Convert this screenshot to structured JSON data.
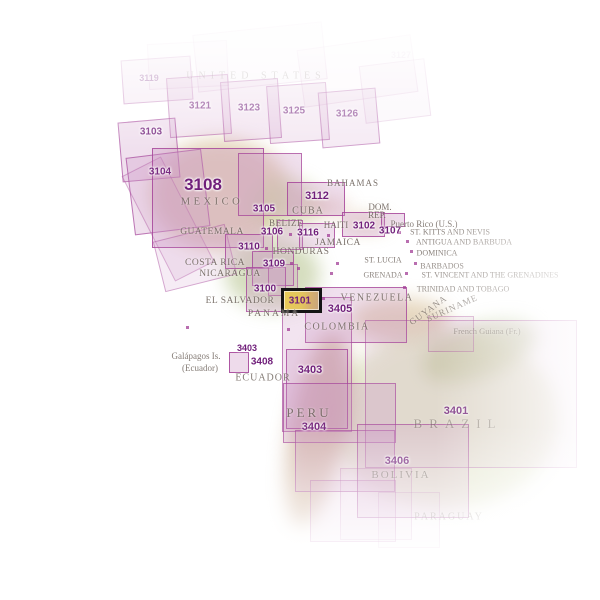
{
  "map": {
    "colors": {
      "region_fill_rgb": "206,152,198",
      "region_border_rgb": "162,62,150",
      "number_text": "#701f7a",
      "country_text": "#6f655e",
      "highlight_border": "#141414",
      "highlight_fill": "#e3c45e"
    },
    "highlight": {
      "label": "3101",
      "x": 281,
      "y": 288,
      "w": 41,
      "h": 25,
      "label_size": 10
    },
    "boxes": [
      {
        "name": "3119",
        "x": 122,
        "y": 58,
        "w": 70,
        "h": 44,
        "rot": -4,
        "fa": 0.18,
        "ba": 0.4
      },
      {
        "name": "3121",
        "x": 168,
        "y": 76,
        "w": 62,
        "h": 60,
        "rot": -4,
        "fa": 0.25,
        "ba": 0.5
      },
      {
        "name": "3123",
        "x": 222,
        "y": 80,
        "w": 58,
        "h": 60,
        "rot": -4,
        "fa": 0.25,
        "ba": 0.5
      },
      {
        "name": "3125",
        "x": 268,
        "y": 84,
        "w": 60,
        "h": 58,
        "rot": -4,
        "fa": 0.22,
        "ba": 0.45
      },
      {
        "name": "3126",
        "x": 320,
        "y": 90,
        "w": 58,
        "h": 56,
        "rot": -5,
        "fa": 0.2,
        "ba": 0.45
      },
      {
        "name": "us-faint-a",
        "x": 195,
        "y": 28,
        "w": 130,
        "h": 58,
        "rot": -6,
        "fa": 0.08,
        "ba": 0.15
      },
      {
        "name": "us-faint-b",
        "x": 300,
        "y": 42,
        "w": 115,
        "h": 58,
        "rot": -8,
        "fa": 0.07,
        "ba": 0.12
      },
      {
        "name": "us-faint-c",
        "x": 148,
        "y": 42,
        "w": 80,
        "h": 46,
        "rot": -3,
        "fa": 0.07,
        "ba": 0.12
      },
      {
        "name": "us-faint-d",
        "x": 362,
        "y": 62,
        "w": 66,
        "h": 58,
        "rot": -7,
        "fa": 0.08,
        "ba": 0.15
      },
      {
        "name": "3103",
        "x": 120,
        "y": 120,
        "w": 58,
        "h": 60,
        "rot": -5,
        "fa": 0.3,
        "ba": 0.65
      },
      {
        "name": "3104",
        "x": 130,
        "y": 153,
        "w": 76,
        "h": 78,
        "rot": -7,
        "fa": 0.3,
        "ba": 0.65
      },
      {
        "name": "baja-strip",
        "x": 146,
        "y": 160,
        "w": 44,
        "h": 118,
        "rot": -27,
        "fa": 0.18,
        "ba": 0.35
      },
      {
        "name": "3108",
        "x": 152,
        "y": 148,
        "w": 112,
        "h": 100,
        "rot": 0,
        "fa": 0.34,
        "ba": 0.8
      },
      {
        "name": "3108-coastal",
        "x": 158,
        "y": 232,
        "w": 74,
        "h": 52,
        "rot": -14,
        "fa": 0.18,
        "ba": 0.4
      },
      {
        "name": "3105",
        "x": 238,
        "y": 153,
        "w": 64,
        "h": 63,
        "rot": 0,
        "fa": 0.3,
        "ba": 0.7
      },
      {
        "name": "3112",
        "x": 287,
        "y": 182,
        "w": 58,
        "h": 34,
        "rot": 0,
        "fa": 0.32,
        "ba": 0.8
      },
      {
        "name": "3102",
        "x": 342,
        "y": 212,
        "w": 43,
        "h": 25,
        "rot": 0,
        "fa": 0.32,
        "ba": 0.8
      },
      {
        "name": "3107",
        "x": 381,
        "y": 213,
        "w": 24,
        "h": 14,
        "rot": 0,
        "fa": 0.32,
        "ba": 0.8
      },
      {
        "name": "3106",
        "x": 277,
        "y": 220,
        "w": 26,
        "h": 30,
        "rot": 0,
        "fa": 0.3,
        "ba": 0.75
      },
      {
        "name": "3116",
        "x": 299,
        "y": 223,
        "w": 36,
        "h": 25,
        "rot": 0,
        "fa": 0.3,
        "ba": 0.75
      },
      {
        "name": "3110",
        "x": 225,
        "y": 234,
        "w": 48,
        "h": 35,
        "rot": 0,
        "fa": 0.3,
        "ba": 0.75
      },
      {
        "name": "3109",
        "x": 252,
        "y": 251,
        "w": 42,
        "h": 35,
        "rot": 0,
        "fa": 0.3,
        "ba": 0.75
      },
      {
        "name": "3100",
        "x": 246,
        "y": 267,
        "w": 40,
        "h": 45,
        "rot": 0,
        "fa": 0.3,
        "ba": 0.75
      },
      {
        "name": "central-small",
        "x": 268,
        "y": 264,
        "w": 30,
        "h": 32,
        "rot": 0,
        "fa": 0.22,
        "ba": 0.5
      },
      {
        "name": "3405",
        "x": 305,
        "y": 287,
        "w": 102,
        "h": 56,
        "rot": 0,
        "fa": 0.3,
        "ba": 0.75
      },
      {
        "name": "colombia-tall",
        "x": 282,
        "y": 297,
        "w": 70,
        "h": 135,
        "rot": 0,
        "fa": 0.26,
        "ba": 0.6
      },
      {
        "name": "3403",
        "x": 286,
        "y": 349,
        "w": 62,
        "h": 80,
        "rot": 0,
        "fa": 0.3,
        "ba": 0.75
      },
      {
        "name": "3408-galapagos",
        "x": 229,
        "y": 352,
        "w": 20,
        "h": 21,
        "rot": 0,
        "fa": 0.35,
        "ba": 0.85
      },
      {
        "name": "3404-upper",
        "x": 283,
        "y": 383,
        "w": 113,
        "h": 60,
        "rot": 0,
        "fa": 0.28,
        "ba": 0.65
      },
      {
        "name": "3404-lower",
        "x": 295,
        "y": 430,
        "w": 100,
        "h": 62,
        "rot": 0,
        "fa": 0.26,
        "ba": 0.6
      },
      {
        "name": "3404-tail",
        "x": 310,
        "y": 480,
        "w": 86,
        "h": 62,
        "rot": 0,
        "fa": 0.18,
        "ba": 0.4
      },
      {
        "name": "3401",
        "x": 365,
        "y": 320,
        "w": 212,
        "h": 148,
        "rot": 0,
        "fa": 0.16,
        "ba": 0.45
      },
      {
        "name": "3401-step",
        "x": 428,
        "y": 316,
        "w": 46,
        "h": 36,
        "rot": 0,
        "fa": 0.12,
        "ba": 0.35
      },
      {
        "name": "3406",
        "x": 357,
        "y": 424,
        "w": 112,
        "h": 94,
        "rot": 0,
        "fa": 0.24,
        "ba": 0.6
      },
      {
        "name": "bottom-faint-a",
        "x": 340,
        "y": 468,
        "w": 72,
        "h": 72,
        "rot": 0,
        "fa": 0.1,
        "ba": 0.25
      },
      {
        "name": "bottom-faint-b",
        "x": 378,
        "y": 492,
        "w": 62,
        "h": 56,
        "rot": 0,
        "fa": 0.08,
        "ba": 0.2
      }
    ],
    "number_labels": [
      {
        "text": "3119",
        "x": 149,
        "y": 78,
        "size": 9,
        "o": 0.55
      },
      {
        "text": "3121",
        "x": 200,
        "y": 106,
        "size": 10,
        "o": 0.8
      },
      {
        "text": "3123",
        "x": 249,
        "y": 108,
        "size": 10,
        "o": 0.8
      },
      {
        "text": "3125",
        "x": 294,
        "y": 111,
        "size": 10,
        "o": 0.75
      },
      {
        "text": "3126",
        "x": 347,
        "y": 114,
        "size": 10,
        "o": 0.7
      },
      {
        "text": "3127",
        "x": 401,
        "y": 55,
        "size": 9,
        "o": 0.12
      },
      {
        "text": "3103",
        "x": 151,
        "y": 132,
        "size": 10,
        "o": 0.9
      },
      {
        "text": "3104",
        "x": 160,
        "y": 172,
        "size": 10,
        "o": 0.9
      },
      {
        "text": "3108",
        "x": 203,
        "y": 185,
        "size": 17,
        "o": 1
      },
      {
        "text": "3105",
        "x": 264,
        "y": 209,
        "size": 10,
        "o": 1
      },
      {
        "text": "3112",
        "x": 317,
        "y": 196,
        "size": 11,
        "o": 1
      },
      {
        "text": "3102",
        "x": 364,
        "y": 226,
        "size": 10,
        "o": 1
      },
      {
        "text": "3107",
        "x": 390,
        "y": 231,
        "size": 10,
        "o": 1
      },
      {
        "text": "3106",
        "x": 272,
        "y": 232,
        "size": 10,
        "o": 1
      },
      {
        "text": "3116",
        "x": 308,
        "y": 233,
        "size": 10,
        "o": 1
      },
      {
        "text": "3110",
        "x": 249,
        "y": 247,
        "size": 10,
        "o": 1
      },
      {
        "text": "3109",
        "x": 274,
        "y": 264,
        "size": 10,
        "o": 1
      },
      {
        "text": "3100",
        "x": 265,
        "y": 289,
        "size": 10,
        "o": 1
      },
      {
        "text": "3405",
        "x": 340,
        "y": 309,
        "size": 11,
        "o": 1
      },
      {
        "text": "3403",
        "x": 247,
        "y": 348,
        "size": 9,
        "o": 1
      },
      {
        "text": "3408",
        "x": 262,
        "y": 362,
        "size": 10,
        "o": 1
      },
      {
        "text": "3403",
        "x": 310,
        "y": 370,
        "size": 11,
        "o": 1
      },
      {
        "text": "3404",
        "x": 314,
        "y": 427,
        "size": 11,
        "o": 0.9
      },
      {
        "text": "3401",
        "x": 456,
        "y": 411,
        "size": 11,
        "o": 0.85
      },
      {
        "text": "3406",
        "x": 397,
        "y": 461,
        "size": 11,
        "o": 0.85
      }
    ],
    "country_labels": [
      {
        "text": "UNITED STATES",
        "x": 256,
        "y": 76,
        "size": 10,
        "ls": 5,
        "o": 0.4
      },
      {
        "text": "MEXICO",
        "x": 212,
        "y": 202,
        "size": 10.5,
        "ls": 3.5,
        "o": 0.85
      },
      {
        "text": "BAHAMAS",
        "x": 353,
        "y": 183,
        "size": 9,
        "ls": 1,
        "o": 0.9
      },
      {
        "text": "CUBA",
        "x": 308,
        "y": 211,
        "size": 10,
        "ls": 1,
        "o": 0.9
      },
      {
        "text": "BELIZE",
        "x": 286,
        "y": 223,
        "size": 9,
        "ls": 0.5,
        "o": 0.9
      },
      {
        "text": "GUATEMALA",
        "x": 212,
        "y": 232,
        "size": 9.5,
        "ls": 0.5,
        "o": 0.9
      },
      {
        "text": "HAITI",
        "x": 336,
        "y": 225,
        "size": 9,
        "ls": 0,
        "o": 0.9
      },
      {
        "text": "DOM.",
        "x": 380,
        "y": 207,
        "size": 9,
        "ls": 0,
        "o": 0.9
      },
      {
        "text": "REP.",
        "x": 377,
        "y": 215,
        "size": 9,
        "ls": 0,
        "o": 0.9
      },
      {
        "text": "JAMAICA",
        "x": 338,
        "y": 243,
        "size": 9.5,
        "ls": 0.5,
        "o": 0.9
      },
      {
        "text": "HONDURAS",
        "x": 301,
        "y": 252,
        "size": 9.5,
        "ls": 0.5,
        "o": 0.9
      },
      {
        "text": "COSTA RICA",
        "x": 215,
        "y": 263,
        "size": 9.5,
        "ls": 0.5,
        "o": 0.9
      },
      {
        "text": "NICARAGUA",
        "x": 230,
        "y": 274,
        "size": 9.5,
        "ls": 0.5,
        "o": 0.9
      },
      {
        "text": "EL SALVADOR",
        "x": 240,
        "y": 301,
        "size": 9.5,
        "ls": 0.5,
        "o": 0.9
      },
      {
        "text": "PANAMA",
        "x": 274,
        "y": 314,
        "size": 9.5,
        "ls": 2,
        "o": 0.9
      },
      {
        "text": "Puerto Rico (U.S.)",
        "x": 424,
        "y": 224,
        "size": 9,
        "ls": 0,
        "o": 0.85
      },
      {
        "text": "ST. KITTS AND NEVIS",
        "x": 450,
        "y": 232,
        "size": 8,
        "ls": 0,
        "o": 0.8
      },
      {
        "text": "ANTIGUA AND BARBUDA",
        "x": 464,
        "y": 242,
        "size": 8,
        "ls": 0,
        "o": 0.75
      },
      {
        "text": "DOMINICA",
        "x": 437,
        "y": 253,
        "size": 8,
        "ls": 0,
        "o": 0.8
      },
      {
        "text": "ST. LUCIA",
        "x": 383,
        "y": 260,
        "size": 8,
        "ls": 0,
        "o": 0.85
      },
      {
        "text": "BARBADOS",
        "x": 442,
        "y": 266,
        "size": 8,
        "ls": 0,
        "o": 0.75
      },
      {
        "text": "ST. VINCENT AND THE GRENADINES",
        "x": 490,
        "y": 275,
        "size": 8,
        "ls": 0,
        "o": 0.7
      },
      {
        "text": "GRENADA",
        "x": 383,
        "y": 275,
        "size": 8,
        "ls": 0,
        "o": 0.8
      },
      {
        "text": "TRINIDAD AND TOBAGO",
        "x": 463,
        "y": 289,
        "size": 8,
        "ls": 0,
        "o": 0.7
      },
      {
        "text": "VENEZUELA",
        "x": 377,
        "y": 298,
        "size": 10,
        "ls": 1.5,
        "o": 0.85
      },
      {
        "text": "GUYANA",
        "x": 428,
        "y": 310,
        "size": 9,
        "ls": 1,
        "o": 0.7,
        "rot": -36
      },
      {
        "text": "SURINAME",
        "x": 452,
        "y": 308,
        "size": 9,
        "ls": 1,
        "o": 0.65,
        "rot": -24
      },
      {
        "text": "French Guiana (Fr.)",
        "x": 487,
        "y": 331,
        "size": 8.5,
        "ls": 0,
        "o": 0.6
      },
      {
        "text": "COLOMBIA",
        "x": 337,
        "y": 327,
        "size": 10,
        "ls": 1.5,
        "o": 0.85
      },
      {
        "text": "Galápagos Is.",
        "x": 196,
        "y": 356,
        "size": 9,
        "ls": 0,
        "o": 0.85
      },
      {
        "text": "(Ecuador)",
        "x": 200,
        "y": 368,
        "size": 9,
        "ls": 0,
        "o": 0.85
      },
      {
        "text": "ECUADOR",
        "x": 263,
        "y": 378,
        "size": 10,
        "ls": 1,
        "o": 0.85
      },
      {
        "text": "PERU",
        "x": 309,
        "y": 413,
        "size": 13,
        "ls": 3,
        "o": 0.85
      },
      {
        "text": "BRAZIL",
        "x": 458,
        "y": 424,
        "size": 13,
        "ls": 7,
        "o": 0.5
      },
      {
        "text": "BOLIVIA",
        "x": 401,
        "y": 475,
        "size": 11,
        "ls": 2,
        "o": 0.65
      },
      {
        "text": "PARAGUAY",
        "x": 449,
        "y": 517,
        "size": 10,
        "ls": 2,
        "o": 0.5
      }
    ],
    "island_dots": [
      {
        "x": 398,
        "y": 231
      },
      {
        "x": 406,
        "y": 240
      },
      {
        "x": 410,
        "y": 250
      },
      {
        "x": 414,
        "y": 262
      },
      {
        "x": 405,
        "y": 272
      },
      {
        "x": 403,
        "y": 286
      },
      {
        "x": 336,
        "y": 262
      },
      {
        "x": 289,
        "y": 233
      },
      {
        "x": 327,
        "y": 234
      },
      {
        "x": 265,
        "y": 247
      },
      {
        "x": 290,
        "y": 262
      },
      {
        "x": 297,
        "y": 267
      },
      {
        "x": 330,
        "y": 272
      },
      {
        "x": 322,
        "y": 297
      },
      {
        "x": 287,
        "y": 328
      },
      {
        "x": 186,
        "y": 326
      },
      {
        "x": 240,
        "y": 346
      }
    ]
  }
}
